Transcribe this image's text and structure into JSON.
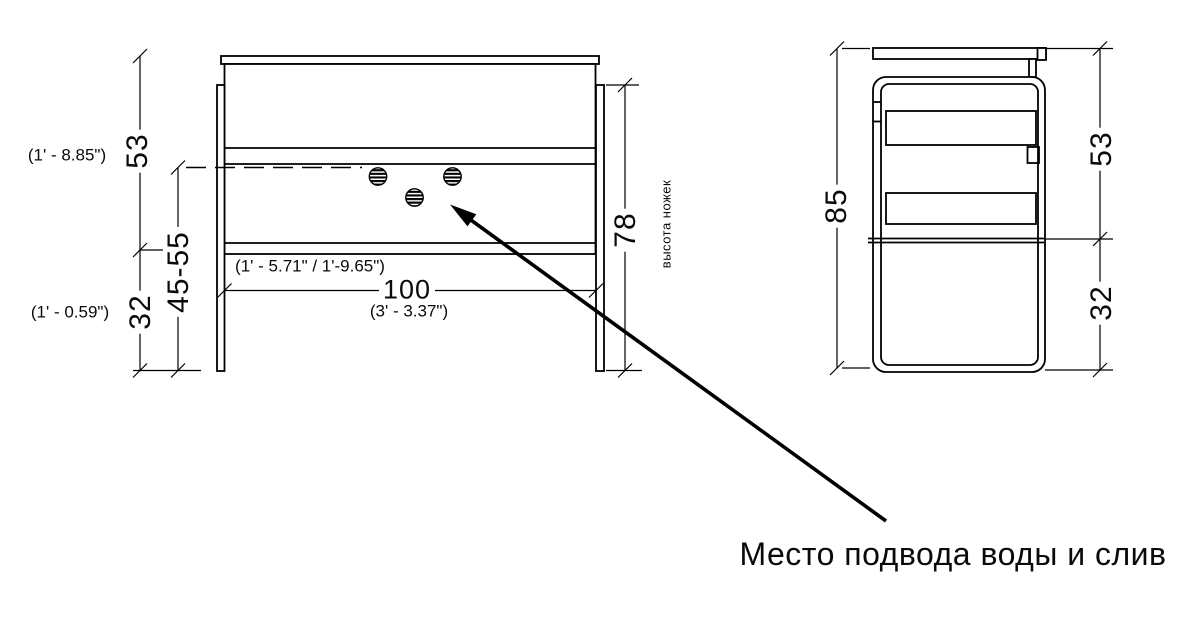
{
  "front_view": {
    "height_to_shelf": {
      "value": "53",
      "imperial": "(1' - 8.85\")"
    },
    "lower_height": {
      "value": "32",
      "imperial": "(1' - 0.59\")"
    },
    "adjustable_range": {
      "value": "45-55",
      "imperial": "(1' - 5.71\" / 1'-9.65\")"
    },
    "width": {
      "value": "100",
      "imperial": "(3' - 3.37\")"
    },
    "legs_height": {
      "value": "78",
      "note": "высота ножек"
    }
  },
  "side_view": {
    "total_height": "85",
    "upper_height": "53",
    "lower_height": "32"
  },
  "callout": {
    "label": "Место подвода воды и слив"
  },
  "colors": {
    "line": "#000000",
    "background": "#ffffff"
  }
}
